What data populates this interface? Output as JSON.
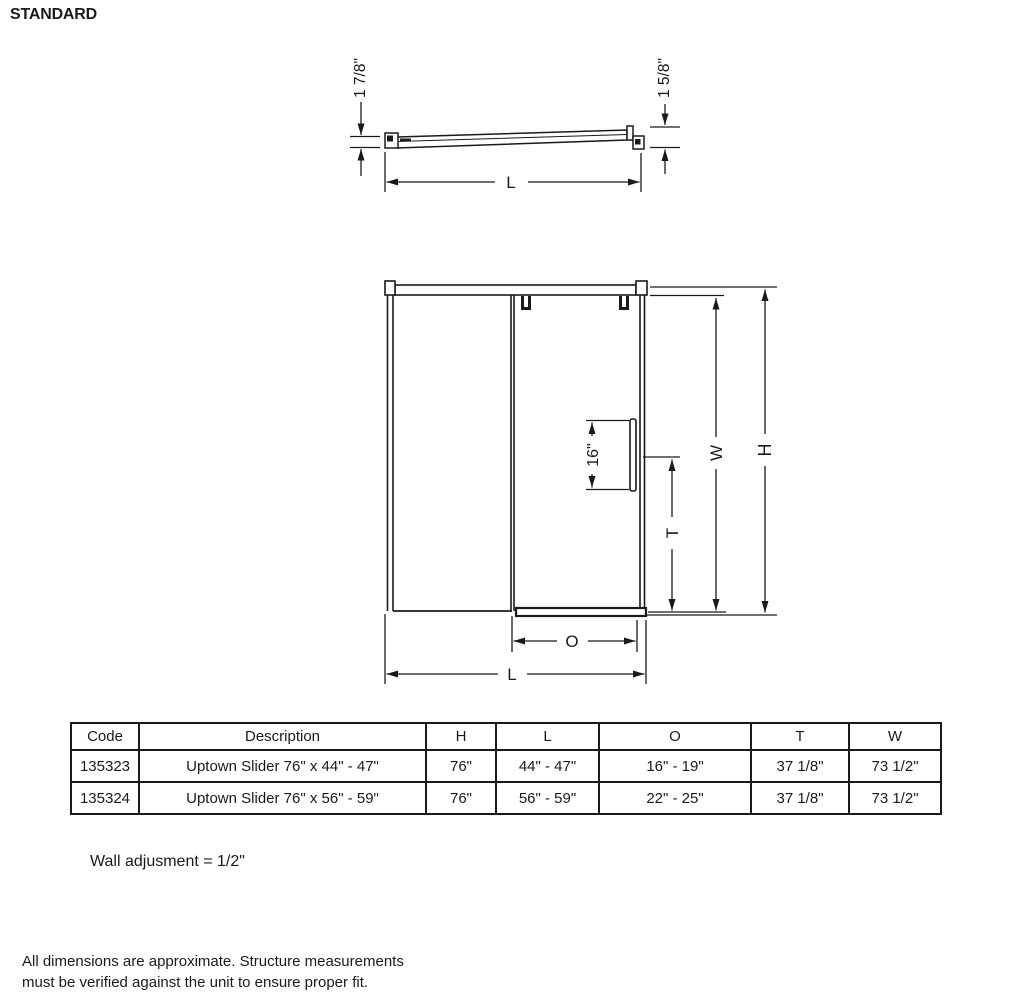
{
  "page": {
    "title": "STANDARD",
    "wall_note": "Wall adjusment = 1/2\"",
    "footer_line1": "All dimensions are approximate. Structure measurements",
    "footer_line2": "must be verified against the unit to ensure proper fit."
  },
  "top_view": {
    "left_thickness": "1 7/8\"",
    "right_thickness": "1 5/8\"",
    "length_label": "L"
  },
  "front_view": {
    "handle_dim": "16\"",
    "t_label": "T",
    "w_label": "W",
    "h_label": "H",
    "o_label": "O",
    "l_label": "L"
  },
  "table": {
    "headers": [
      "Code",
      "Description",
      "H",
      "L",
      "O",
      "T",
      "W"
    ],
    "rows": [
      [
        "135323",
        "Uptown Slider 76\" x 44\" - 47\"",
        "76\"",
        "44\" - 47\"",
        "16\" - 19\"",
        "37 1/8\"",
        "73 1/2\""
      ],
      [
        "135324",
        "Uptown Slider 76\" x 56\" - 59\"",
        "76\"",
        "56\" - 59\"",
        "22\" - 25\"",
        "37 1/8\"",
        "73 1/2\""
      ]
    ]
  },
  "colors": {
    "line": "#1a1a1a",
    "background": "#ffffff"
  }
}
